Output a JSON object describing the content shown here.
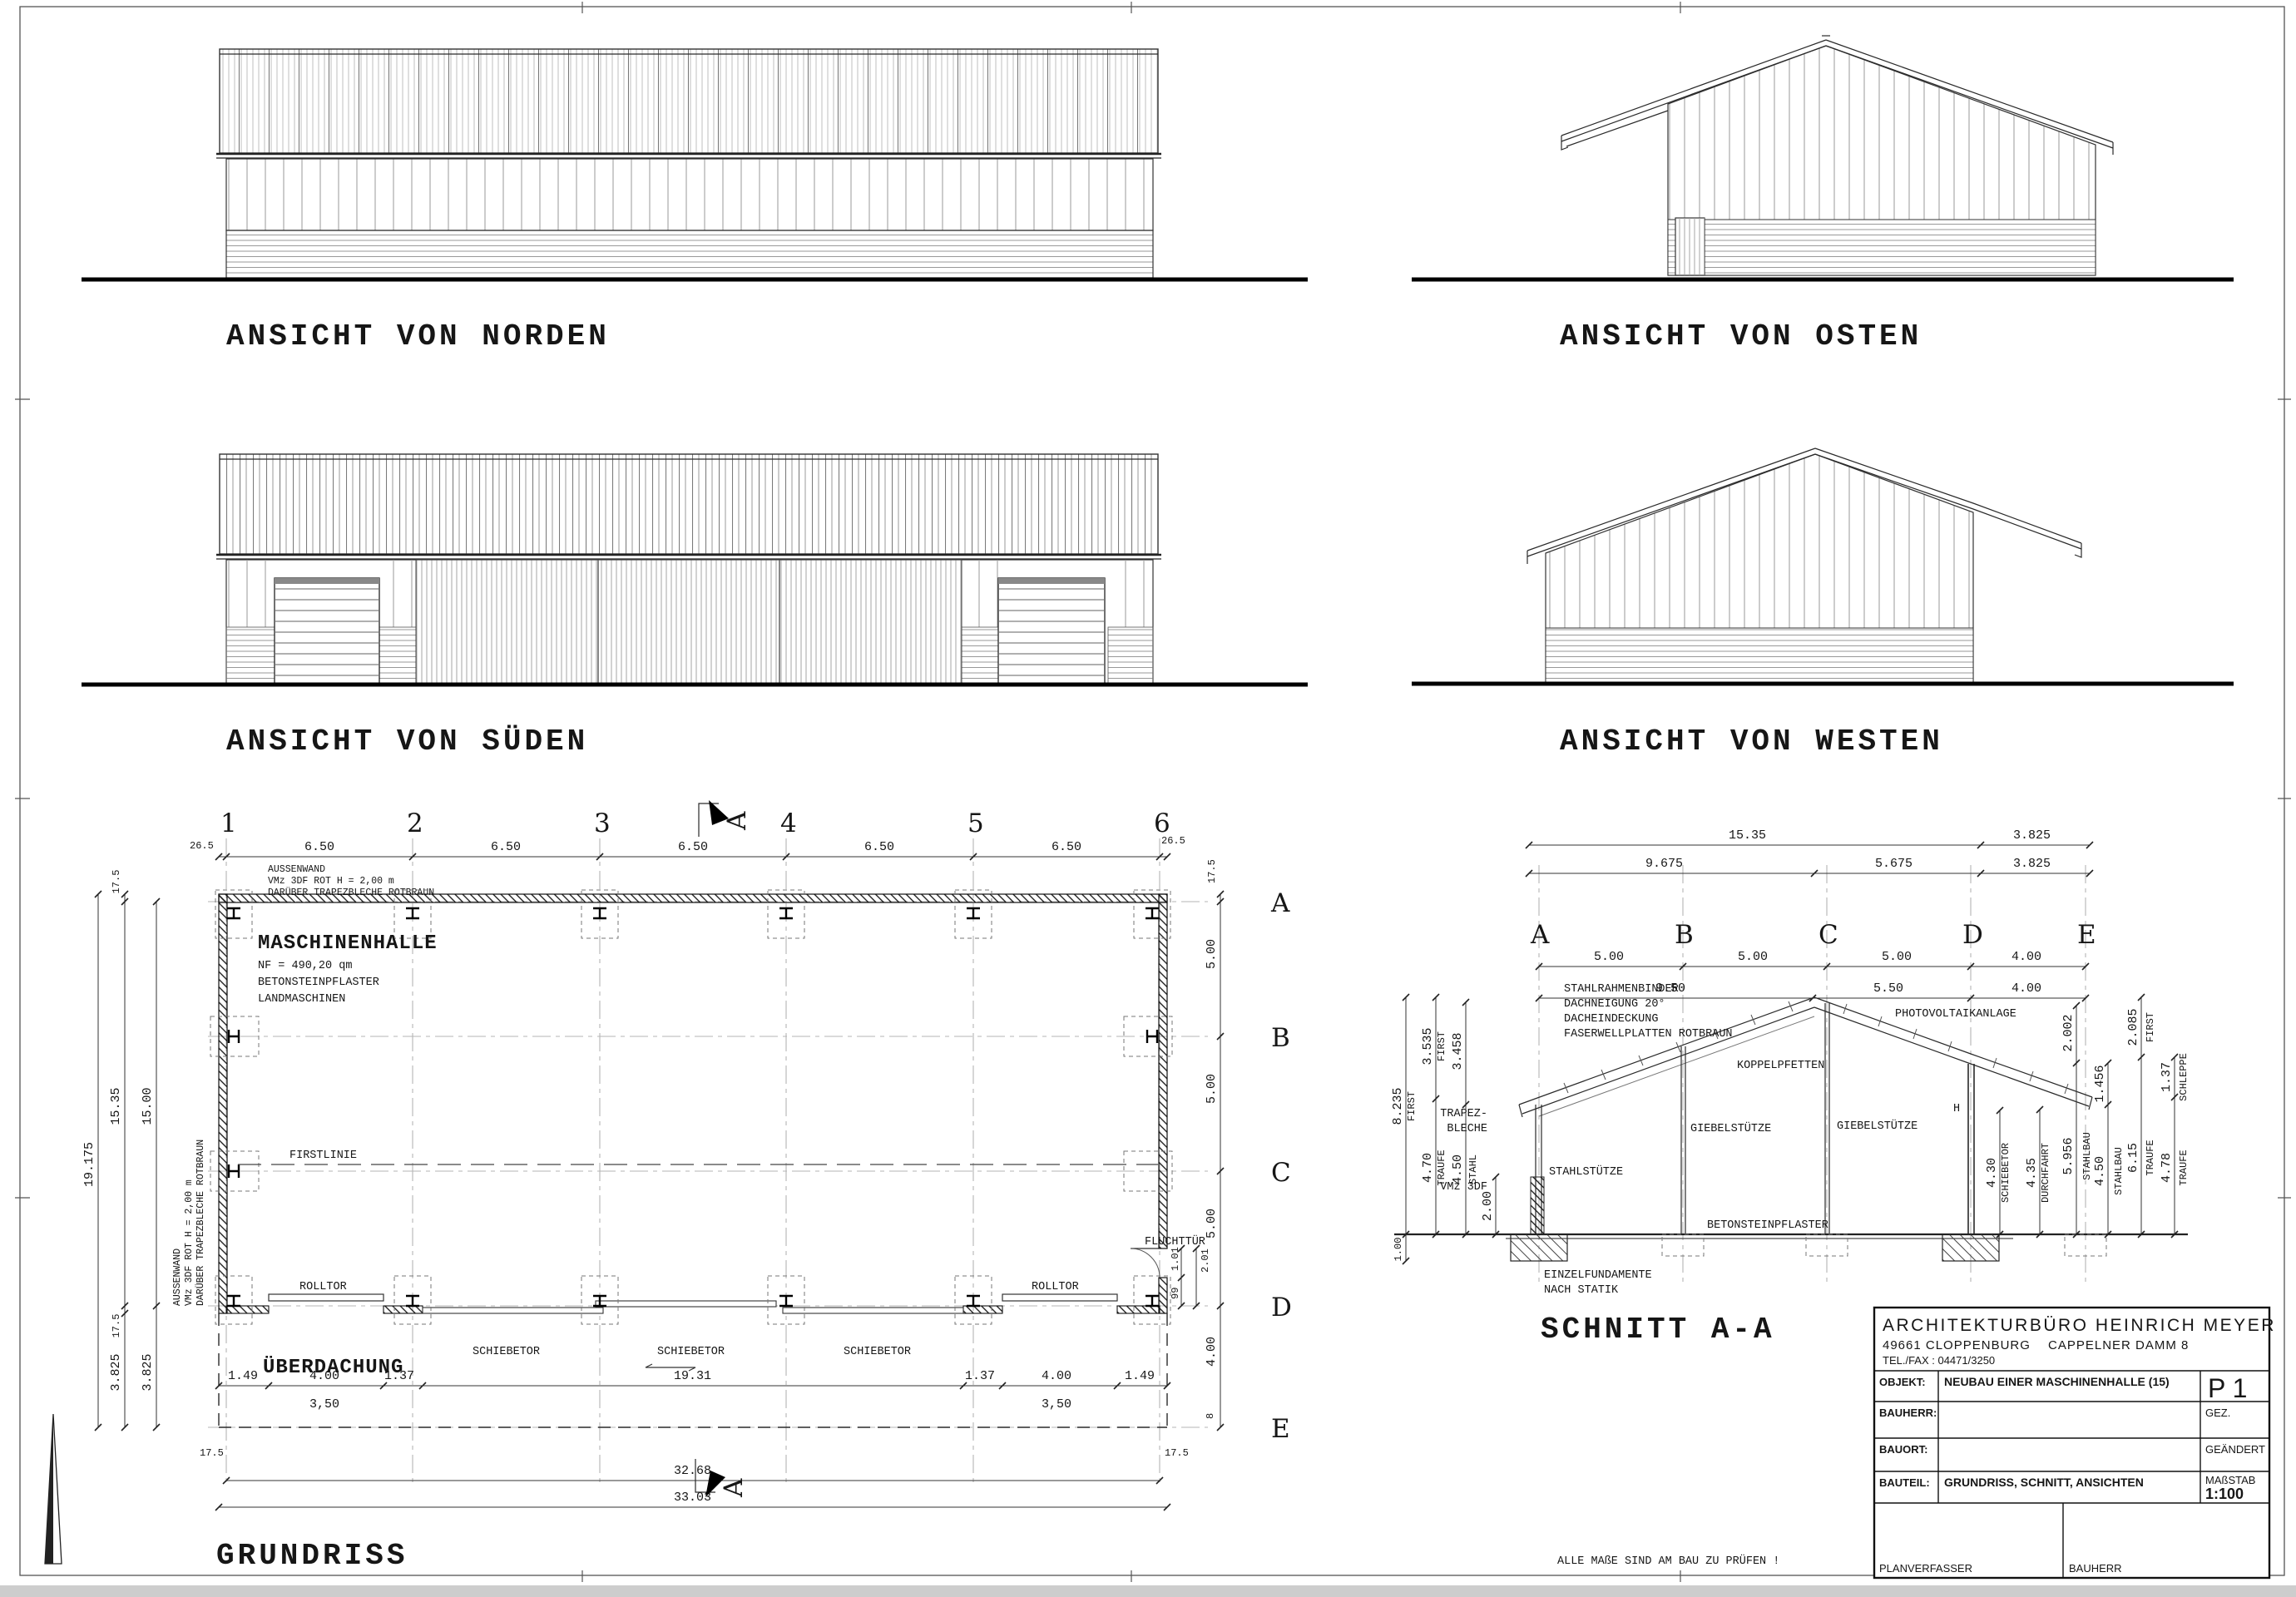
{
  "titles": {
    "north": "ANSICHT VON NORDEN",
    "east": "ANSICHT VON OSTEN",
    "south": "ANSICHT VON SÜDEN",
    "west": "ANSICHT VON WESTEN",
    "section": "SCHNITT A-A",
    "plan": "GRUNDRISS"
  },
  "note": "ALLE MAßE SIND AM BAU ZU PRÜFEN !",
  "plan": {
    "axes": [
      "1",
      "2",
      "3",
      "4",
      "5",
      "6"
    ],
    "rows": [
      "A",
      "B",
      "C",
      "D",
      "E"
    ],
    "marker": "A",
    "top_dims": {
      "end_left": "26.5",
      "bay": "6.50",
      "end_right": "26.5"
    },
    "left_dims": {
      "total": "19.175",
      "outer": "15.35",
      "inner": "15.00",
      "wall_a": "17.5",
      "wall_b": "17.5",
      "canopy_a": "3.825",
      "canopy_b": "3.825"
    },
    "right_dims": {
      "wall": "17.5",
      "ab": "5.00",
      "bc": "5.00",
      "cd": "5.00",
      "de": "4.00",
      "e_off": "8"
    },
    "bottom_dims": {
      "l1": "1.49",
      "l2": "4.00",
      "l3": "1.37",
      "l_clear": "3,50",
      "mid": "19.31",
      "r1": "1.37",
      "r2": "4.00",
      "r3": "1.49",
      "r_clear": "3,50",
      "wall_l": "17.5",
      "wall_r": "17.5",
      "inner": "32.68",
      "outer": "33.03"
    },
    "door_dims": {
      "w": "1.01",
      "total": "2.01",
      "off": "99"
    },
    "room": [
      "MASCHINENHALLE",
      "NF = 490,20 qm",
      "BETONSTEINPFLASTER",
      "LANDMASCHINEN"
    ],
    "wall_note": [
      "AUSSENWAND",
      "VMz 3DF ROT  H = 2,00 m",
      "DARÜBER TRAPEZBLECHE ROTBRAUN"
    ],
    "labels": {
      "firstlinie": "FIRSTLINIE",
      "ueberdachung": "ÜBERDACHUNG",
      "rolltor": "ROLLTOR",
      "schiebetor": "SCHIEBETOR",
      "fluchttuer": "FLUCHTTÜR"
    }
  },
  "section": {
    "letters": [
      "A",
      "B",
      "C",
      "D",
      "E"
    ],
    "r1": [
      "15.35",
      "3.825"
    ],
    "r2": [
      "9.675",
      "5.675",
      "3.825"
    ],
    "r3": [
      "5.00",
      "5.00",
      "5.00",
      "4.00"
    ],
    "r4": [
      "9.50",
      "5.50",
      "4.00"
    ],
    "left": {
      "d1": "8.235",
      "d1w": "FIRST",
      "d2": "3.535",
      "d2w": "FIRST",
      "d3": "4.70",
      "d3w": "TRAUFE",
      "d4": "3.458",
      "d5": "4.50",
      "d5w": "STAHL",
      "d6": "2.00",
      "d7": "1.00"
    },
    "right": {
      "d1": "4.30",
      "d1w": "SCHIEBETOR",
      "d2": "4.35",
      "d2w": "DURCHFAHRT",
      "d3": "5.956",
      "d3w": "STAHLBAU",
      "d3b": "2.002",
      "d4": "4.50",
      "d4w": "STAHLBAU",
      "d4b": "1.456",
      "d5": "6.15",
      "d5w": "TRAUFE",
      "d5b": "2.085",
      "d5bw": "FIRST",
      "d6": "4.78",
      "d6w": "TRAUFE",
      "d6b": "1.37",
      "d6bw": "SCHLEPPE"
    },
    "labels": {
      "binder1": "STAHLRAHMENBINDER",
      "binder2": "DACHNEIGUNG 20°",
      "binder3": "DACHEINDECKUNG",
      "binder4": "FASERWELLPLATTEN ROTBRAUN",
      "pv": "PHOTOVOLTAIKANLAGE",
      "pfetten": "KOPPELPFETTEN",
      "giebel": "GIEBELSTÜTZE",
      "stahl": "STAHLSTÜTZE",
      "trapez1": "TRAPEZ-",
      "trapez2": "BLECHE",
      "vmz": "VMz 3DF",
      "pflaster": "BETONSTEINPFLASTER",
      "fund1": "EINZELFUNDAMENTE",
      "fund2": "NACH STATIK",
      "h": "H"
    }
  },
  "titleblock": {
    "firm": "ARCHITEKTURBÜRO HEINRICH MEYER",
    "address1": "49661 CLOPPENBURG",
    "address2": "CAPPELNER DAMM 8",
    "phone": "TEL./FAX :  04471/3250",
    "objekt_label": "OBJEKT:",
    "objekt": "NEUBAU EINER MASCHINENHALLE (15)",
    "bauherr_label": "BAUHERR:",
    "bauort_label": "BAUORT:",
    "bauteil_label": "BAUTEIL:",
    "bauteil": "GRUNDRISS, SCHNITT, ANSICHTEN",
    "plan_no": "P 1",
    "gez": "GEZ.",
    "geaendert": "GEÄNDERT",
    "massstab_label": "MAßSTAB",
    "massstab": "1:100",
    "planverfasser": "PLANVERFASSER",
    "bauherr_footer": "BAUHERR"
  }
}
